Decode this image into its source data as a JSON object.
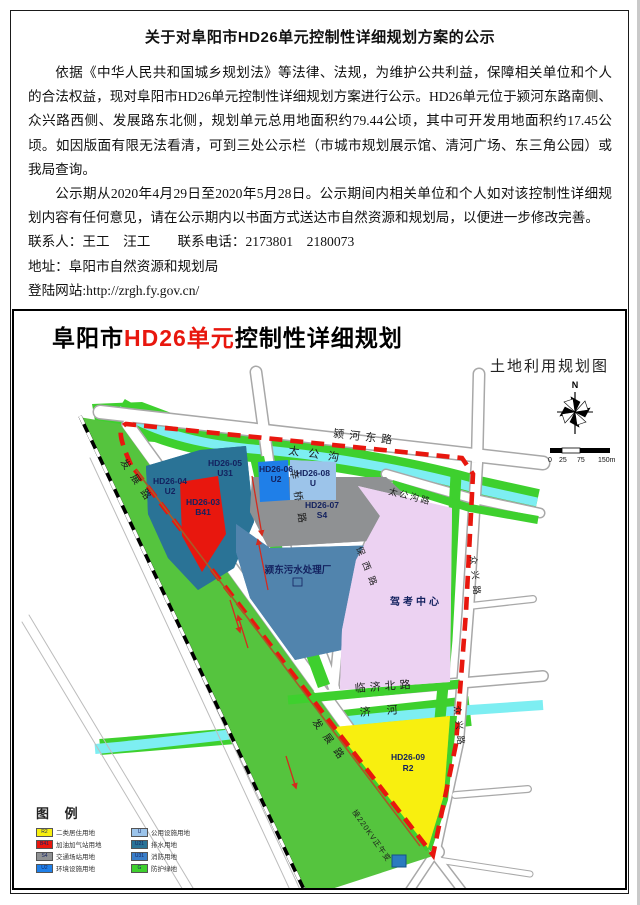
{
  "notice": {
    "title": "关于对阜阳市HD26单元控制性详细规划方案的公示",
    "paragraph1": "依据《中华人民共和国城乡规划法》等法律、法规，为维护公共利益，保障相关单位和个人的合法权益，现对阜阳市HD26单元控制性详细规划方案进行公示。HD26单元位于颍河东路南侧、众兴路西侧、发展路东北侧，规划单元总用地面积约79.44公顷，其中可开发用地面积约17.45公顷。如因版面有限无法看清，可到三处公示栏（市城市规划展示馆、清河广场、东三角公园）或我局查询。",
    "paragraph2": "公示期从2020年4月29日至2020年5月28日。公示期间内相关单位和个人如对该控制性详细规划内容有任何意见，请在公示期内以书面方式送达市自然资源和规划局，以便进一步修改完善。",
    "contact_line": "联系人：王工　汪工　　联系电话：2173801　2180073",
    "address_line": "地址：阜阳市自然资源和规划局",
    "website_line": "登陆网站:http://zrgh.fy.gov.cn/",
    "date": "2020年4月29日"
  },
  "map": {
    "title_prefix": "阜阳市",
    "title_unit": "HD26单元",
    "title_suffix": "控制性详细规划",
    "subtitle": "土地利用规划图",
    "north_label": "N",
    "scale": {
      "t0": "0",
      "t25": "25",
      "t75": "75",
      "t150": "150m"
    },
    "road_labels": {
      "yinghe_east": "颍河东路",
      "taigonggou": "太公沟",
      "taigonggou_road": "太公沟路",
      "xinqiao": "辛桥路",
      "fazhan_upper": "发展路",
      "fazhan_lower": "发展路",
      "baoxi": "保西路",
      "linji_north": "临济北路",
      "jihe": "济河",
      "zhongxing_upper": "众兴路",
      "zhongxing_lower": "众兴路",
      "power_line": "接220KV正午变"
    },
    "places": {
      "sewage_plant": "颍东污水处理厂",
      "driving_center": "驾考中心"
    },
    "blocks": {
      "hd26_03": {
        "code": "HD26-03",
        "use": "B41"
      },
      "hd26_04": {
        "code": "HD26-04",
        "use": "U2"
      },
      "hd26_05": {
        "code": "HD26-05",
        "use": "U31"
      },
      "hd26_06": {
        "code": "HD26-06",
        "use": "U2"
      },
      "hd26_07": {
        "code": "HD26-07",
        "use": "S4"
      },
      "hd26_08": {
        "code": "HD26-08",
        "use": "U"
      },
      "hd26_09": {
        "code": "HD26-09",
        "use": "R2"
      }
    },
    "colors": {
      "boundary_red": "#e8170e",
      "residential_yellow": "#f8ef0f",
      "gas_station_red": "#e8170e",
      "transport_gray": "#8f9193",
      "utility_teal": "#2a7396",
      "utility_blue": "#1f7fe8",
      "utility_lightblue": "#9cc4ea",
      "green_space": "#3ed02e",
      "corridor_green": "#55c43e",
      "water_cyan": "#7deef2",
      "pink_area": "#ecd2f2"
    }
  },
  "legend": {
    "heading": "图 例",
    "items": [
      {
        "color": "#f8ef0f",
        "code": "R2",
        "label": "二类居住用地"
      },
      {
        "color": "#e8170e",
        "code": "B41",
        "label": "加油加气站用地"
      },
      {
        "color": "#8f9193",
        "code": "S4",
        "label": "交通场站用地"
      },
      {
        "color": "#1f7fe8",
        "code": "U2",
        "label": "环境设施用地"
      },
      {
        "color": "#9cc4ea",
        "code": "U",
        "label": "公用设施用地"
      },
      {
        "color": "#2a7396",
        "code": "U21",
        "label": "排水用地"
      },
      {
        "color": "#3a7ec8",
        "code": "U31",
        "label": "消防用地"
      },
      {
        "color": "#3ed02e",
        "code": "G",
        "label": "防护绿地"
      }
    ]
  }
}
